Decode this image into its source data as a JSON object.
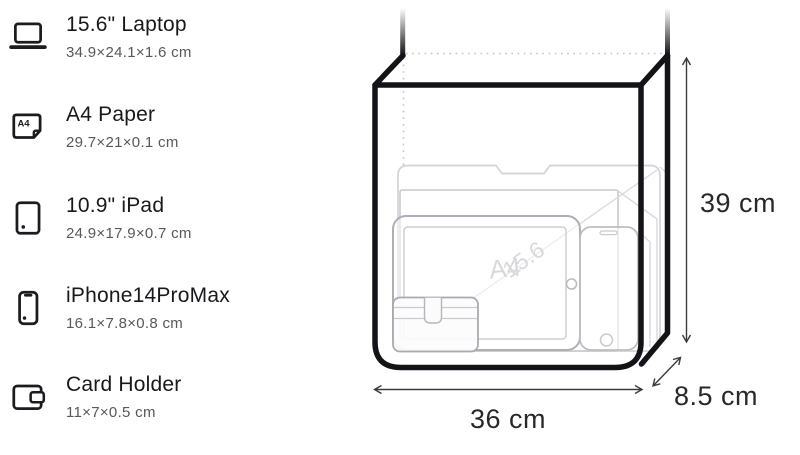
{
  "items": [
    {
      "title": "15.6\" Laptop",
      "dims": "34.9×24.1×1.6 cm"
    },
    {
      "title": "A4 Paper",
      "dims": "29.7×21×0.1 cm"
    },
    {
      "title": "10.9\" iPad",
      "dims": "24.9×17.9×0.7 cm"
    },
    {
      "title": "iPhone14ProMax",
      "dims": "16.1×7.8×0.8 cm"
    },
    {
      "title": "Card Holder",
      "dims": "11×7×0.5 cm"
    }
  ],
  "diagram": {
    "height_label": "39 cm",
    "width_label": "36 cm",
    "depth_label": "8.5 cm",
    "laptop_watermark": "15.6",
    "a4_watermark": "A4"
  },
  "icons": {
    "a4_label": "A4"
  },
  "colors": {
    "bag_outline": "#141418",
    "text_primary": "#19191d",
    "text_secondary": "#57575d",
    "dimension_text": "#28282c",
    "dotted_line": "#c3c3c8",
    "item_stroke_light": "#d3d3d8",
    "item_stroke_mid": "#aeaeb6",
    "watermark": "#d9d9dd"
  }
}
